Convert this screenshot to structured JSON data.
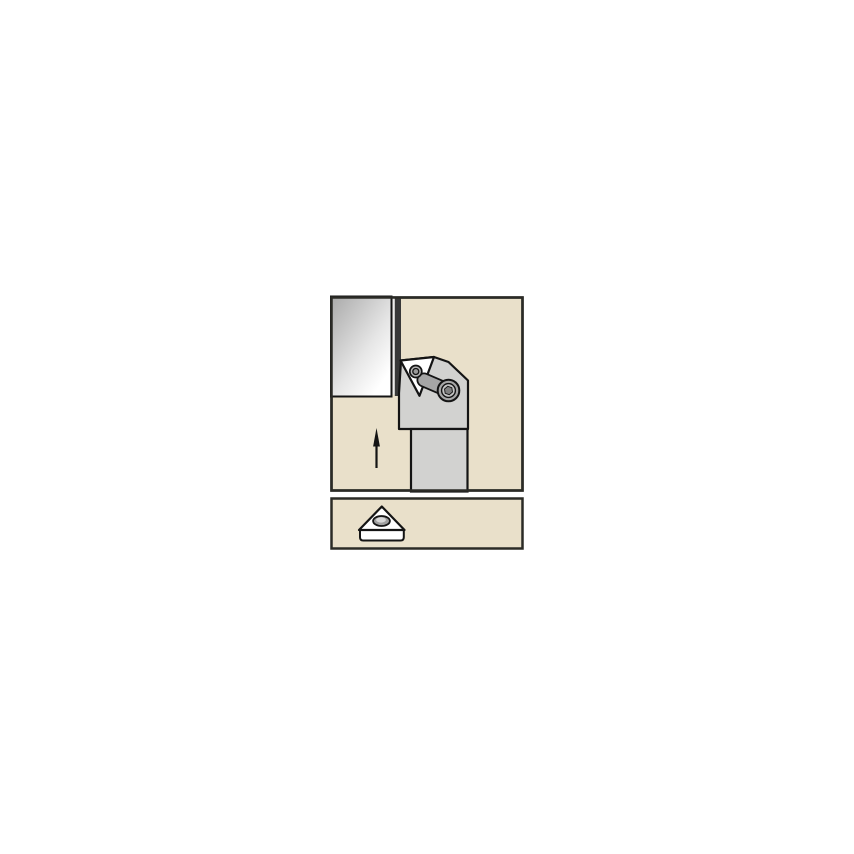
{
  "figure": {
    "kind": "toolholder-application-diagram",
    "main_view": "toolholder-with-workpiece-and-feed-arrow",
    "detail_view": "triangular-insert-3d"
  },
  "colors": {
    "page_bg": "#ffffff",
    "panel_fill": "#e9e0ca",
    "panel_border": "#2b2b26",
    "outline": "#141414",
    "holder_body": "#d2d2d0",
    "clamp": "#a6a6a6",
    "clamp_ring": "#c3c3c3",
    "screw_socket": "#7f7f7f",
    "screw_outer": "#b5b5b5",
    "screw_inner": "#9a9a9a",
    "insert_fill": "#ffffff",
    "workpiece_dark": "#a9a9a9",
    "workpiece_mid": "#e6e6e6",
    "workpiece_light": "#ffffff",
    "edge_gap": "#ececec",
    "edge_band": "#383838",
    "hole_fill": "#9e9e9e",
    "hole_highlight": "#d7d7d7",
    "arrow": "#141414"
  }
}
